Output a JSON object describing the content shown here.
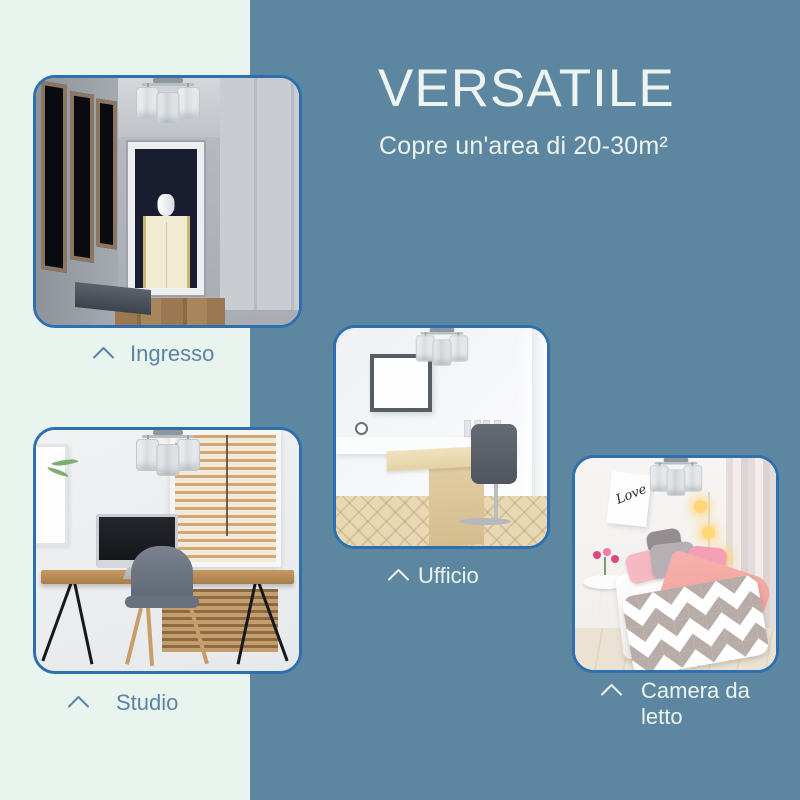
{
  "header": {
    "title": "VERSATILE",
    "subtitle": "Copre un'area di 20-30m²"
  },
  "rooms": [
    {
      "id": "ingresso",
      "label": "Ingresso",
      "caption_style": "on-light",
      "marker_icon": "chevron-up"
    },
    {
      "id": "ufficio",
      "label": "Ufficio",
      "caption_style": "on-dark",
      "marker_icon": "chevron-up"
    },
    {
      "id": "studio",
      "label": "Studio",
      "caption_style": "on-light",
      "marker_icon": "chevron-up"
    },
    {
      "id": "camera-da-letto",
      "label": "Camera da letto",
      "caption_style": "on-dark",
      "marker_icon": "chevron-up"
    }
  ],
  "bedroom_poster_text": "Love",
  "colors": {
    "panel_left": "#e9f4ee",
    "panel_right": "#5d87a1",
    "card_border": "#2e6fae",
    "caption_on_light": "#5b84a4",
    "caption_on_dark": "#edf4ef",
    "title_text": "#edf4ef"
  }
}
